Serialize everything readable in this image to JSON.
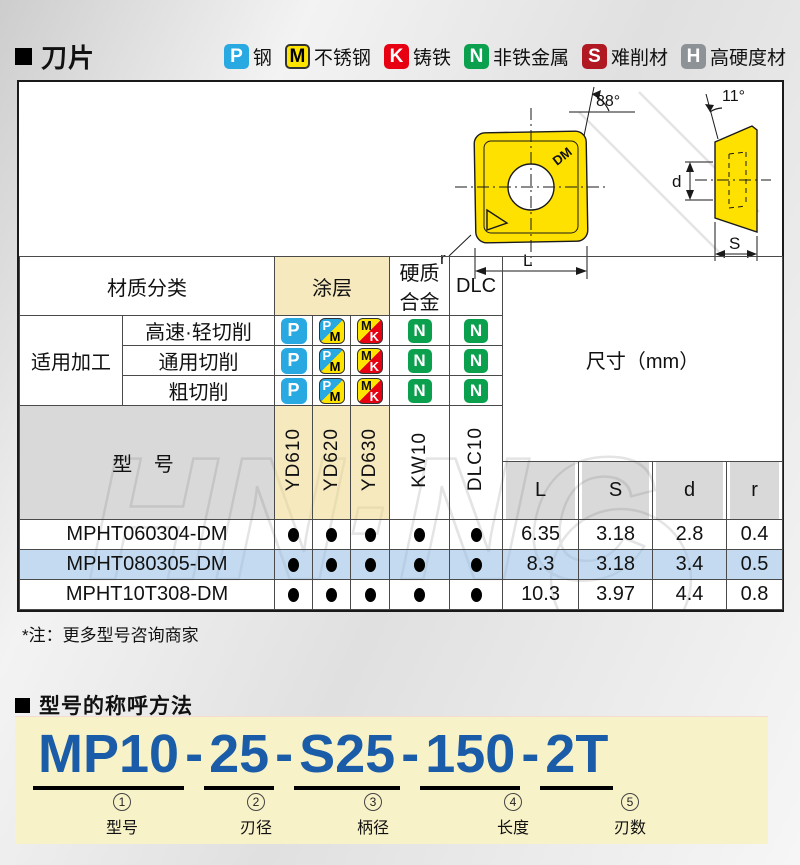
{
  "section1": {
    "title": "刀片"
  },
  "legend": {
    "items": [
      {
        "code": "P",
        "label": "钢"
      },
      {
        "code": "M",
        "label": "不锈钢"
      },
      {
        "code": "K",
        "label": "铸铁"
      },
      {
        "code": "N",
        "label": "非铁金属"
      },
      {
        "code": "S",
        "label": "难削材"
      },
      {
        "code": "H",
        "label": "高硬度材"
      }
    ]
  },
  "drawing": {
    "angle_front": "88°",
    "angle_side": "11°",
    "mark": "DM",
    "dim_length": "L",
    "dim_radius": "r",
    "dim_hole": "d",
    "dim_thickness": "S"
  },
  "table": {
    "header": {
      "material_class": "材质分类",
      "coating": "涂层",
      "carbide": "硬质合金",
      "dlc": "DLC",
      "application": "适用加工",
      "model": "型 号",
      "size_label": "尺寸（mm）",
      "dims": [
        "L",
        "S",
        "d",
        "r"
      ]
    },
    "app_rows": [
      {
        "label": "高速·轻切削"
      },
      {
        "label": "通用切削"
      },
      {
        "label": "粗切削"
      }
    ],
    "icons": {
      "p": "P",
      "pm": [
        "P",
        "M"
      ],
      "mk": [
        "M",
        "K"
      ],
      "n": "N"
    },
    "grades": [
      "YD610",
      "YD620",
      "YD630",
      "KW10",
      "DLC10"
    ],
    "rows": [
      {
        "model": "MPHT060304-DM",
        "dots": [
          true,
          true,
          true,
          true,
          true
        ],
        "dims": [
          "6.35",
          "3.18",
          "2.8",
          "0.4"
        ],
        "highlight": false
      },
      {
        "model": "MPHT080305-DM",
        "dots": [
          true,
          true,
          true,
          true,
          true
        ],
        "dims": [
          "8.3",
          "3.18",
          "3.4",
          "0.5"
        ],
        "highlight": true
      },
      {
        "model": "MPHT10T308-DM",
        "dots": [
          true,
          true,
          true,
          true,
          true
        ],
        "dims": [
          "10.3",
          "3.97",
          "4.4",
          "0.8"
        ],
        "highlight": false
      }
    ]
  },
  "note": {
    "text": "*注：更多型号咨询商家"
  },
  "naming": {
    "title": "型号的称呼方法",
    "model": "MP10-25-S25-150-2T",
    "separator": "-",
    "segments": [
      {
        "text": "MP10",
        "num": "1",
        "label": "型号"
      },
      {
        "text": "25",
        "num": "2",
        "label": "刃径"
      },
      {
        "text": "S25",
        "num": "3",
        "label": "柄径"
      },
      {
        "text": "150",
        "num": "4",
        "label": "长度"
      },
      {
        "text": "2T",
        "num": "5",
        "label": "刃数"
      }
    ]
  },
  "watermark": {
    "text": "HN·NC"
  },
  "colors": {
    "p_blue": "#29a9e1",
    "m_yellow": "#ffe400",
    "k_red": "#e60012",
    "n_green": "#0aa04e",
    "s_darkred": "#b01922",
    "h_gray": "#8c9296",
    "insert_yellow": "#ffe100",
    "coating_cream": "#f7ebc4",
    "header_gray": "#d9d9d9",
    "highlight_row_blue": "#c9ddf1",
    "naming_bg": "#f8f2c8",
    "model_blue": "#1a5ca8"
  }
}
